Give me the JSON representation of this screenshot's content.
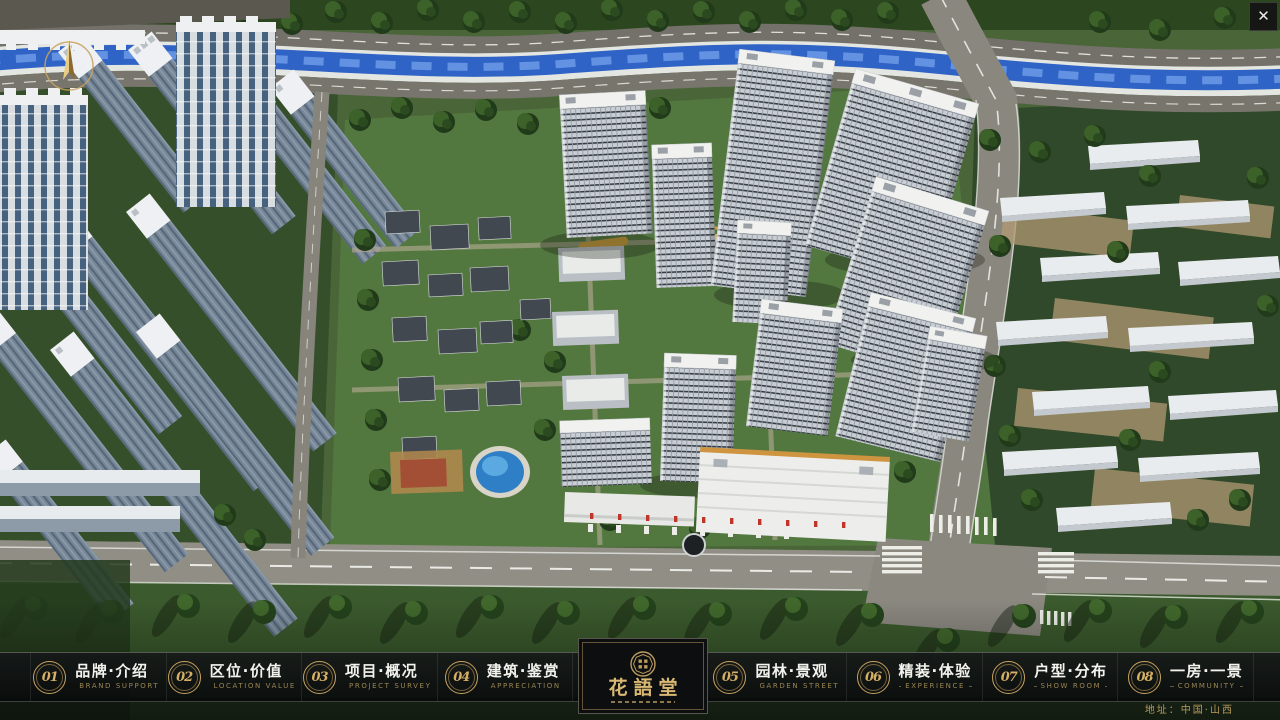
{
  "window": {
    "close_label": "✕"
  },
  "nav": {
    "items": [
      {
        "number": "01",
        "label": "品牌·介绍",
        "sublabel": "BRAND SUPPORT"
      },
      {
        "number": "02",
        "label": "区位·价值",
        "sublabel": "LOCATION VALUE"
      },
      {
        "number": "03",
        "label": "项目·概况",
        "sublabel": "PROJECT SURVEY"
      },
      {
        "number": "04",
        "label": "建筑·鉴赏",
        "sublabel": "APPRECIATION"
      },
      {
        "number": "05",
        "label": "园林·景观",
        "sublabel": "GARDEN STREET"
      },
      {
        "number": "06",
        "label": "精装·体验",
        "sublabel": "EXPERIENCE"
      },
      {
        "number": "07",
        "label": "户型·分布",
        "sublabel": "SHOW ROOM"
      },
      {
        "number": "08",
        "label": "一房·一景",
        "sublabel": "COMMUNITY"
      }
    ],
    "logo": {
      "title": "花語堂"
    },
    "address": "地址：中国·山西"
  },
  "colors": {
    "accent_gold": "#c9a25f",
    "bar_background": "#0c0e10",
    "river_blue": "#2f63c6",
    "road_gray": "#78756d",
    "grass_green": "#49663a",
    "building_white": "#eef0f2",
    "flag_red": "#c03529"
  }
}
